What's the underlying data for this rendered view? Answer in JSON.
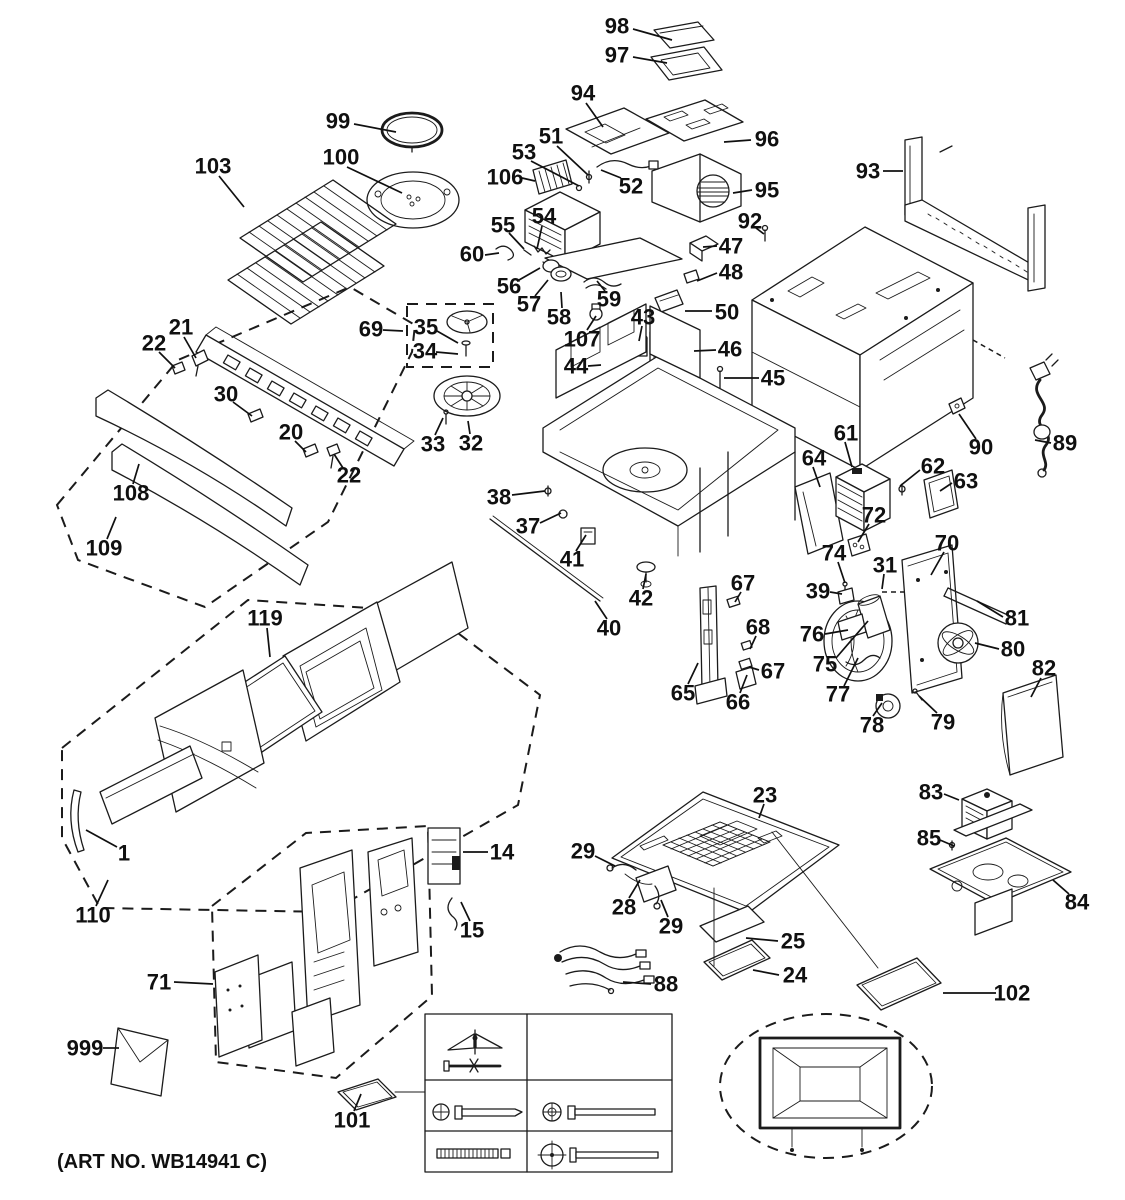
{
  "diagram": {
    "art_no": "(ART NO. WB14941 C)",
    "labels": [
      {
        "id": "98",
        "text": "98",
        "x": 617,
        "y": 26,
        "leader": [
          633,
          29,
          672,
          40
        ]
      },
      {
        "id": "97",
        "text": "97",
        "x": 617,
        "y": 55,
        "leader": [
          633,
          57,
          667,
          63
        ]
      },
      {
        "id": "94",
        "text": "94",
        "x": 583,
        "y": 93,
        "leader": [
          586,
          103,
          603,
          127
        ]
      },
      {
        "id": "99",
        "text": "99",
        "x": 338,
        "y": 121,
        "leader": [
          354,
          124,
          396,
          132
        ]
      },
      {
        "id": "51",
        "text": "51",
        "x": 551,
        "y": 136,
        "leader": [
          557,
          146,
          588,
          175
        ]
      },
      {
        "id": "96",
        "text": "96",
        "x": 767,
        "y": 139,
        "leader": [
          751,
          140,
          724,
          142
        ]
      },
      {
        "id": "53",
        "text": "53",
        "x": 524,
        "y": 152,
        "leader": [
          531,
          161,
          579,
          186
        ]
      },
      {
        "id": "100",
        "text": "100",
        "x": 341,
        "y": 157,
        "leader": [
          347,
          167,
          402,
          193
        ]
      },
      {
        "id": "103",
        "text": "103",
        "x": 213,
        "y": 166,
        "leader": [
          219,
          176,
          244,
          207
        ]
      },
      {
        "id": "93",
        "text": "93",
        "x": 868,
        "y": 171,
        "leader": [
          883,
          171,
          903,
          171
        ]
      },
      {
        "id": "106",
        "text": "106",
        "x": 505,
        "y": 177,
        "leader": [
          522,
          178,
          535,
          181
        ]
      },
      {
        "id": "52",
        "text": "52",
        "x": 631,
        "y": 186,
        "leader": [
          621,
          178,
          601,
          170
        ]
      },
      {
        "id": "95",
        "text": "95",
        "x": 767,
        "y": 190,
        "leader": [
          752,
          190,
          733,
          193
        ]
      },
      {
        "id": "54",
        "text": "54",
        "x": 544,
        "y": 216,
        "leader": [
          542,
          226,
          537,
          249
        ]
      },
      {
        "id": "92",
        "text": "92",
        "x": 750,
        "y": 221,
        "leader": [
          756,
          228,
          764,
          234
        ]
      },
      {
        "id": "55",
        "text": "55",
        "x": 503,
        "y": 225,
        "leader": [
          509,
          233,
          524,
          249
        ]
      },
      {
        "id": "47",
        "text": "47",
        "x": 731,
        "y": 246,
        "leader": [
          717,
          246,
          703,
          247
        ]
      },
      {
        "id": "60",
        "text": "60",
        "x": 472,
        "y": 254,
        "leader": [
          485,
          255,
          499,
          253
        ]
      },
      {
        "id": "48",
        "text": "48",
        "x": 731,
        "y": 272,
        "leader": [
          717,
          273,
          697,
          281
        ]
      },
      {
        "id": "56",
        "text": "56",
        "x": 509,
        "y": 286,
        "leader": [
          519,
          280,
          540,
          268
        ]
      },
      {
        "id": "59",
        "text": "59",
        "x": 609,
        "y": 299,
        "leader": [
          605,
          291,
          597,
          281
        ]
      },
      {
        "id": "57",
        "text": "57",
        "x": 529,
        "y": 304,
        "leader": [
          535,
          296,
          548,
          280
        ]
      },
      {
        "id": "50",
        "text": "50",
        "x": 727,
        "y": 312,
        "leader": [
          712,
          311,
          685,
          311
        ]
      },
      {
        "id": "58",
        "text": "58",
        "x": 559,
        "y": 317,
        "leader": [
          562,
          308,
          561,
          292
        ]
      },
      {
        "id": "43",
        "text": "43",
        "x": 643,
        "y": 317,
        "leader": [
          642,
          326,
          639,
          341
        ]
      },
      {
        "id": "107",
        "text": "107",
        "x": 582,
        "y": 339,
        "leader": [
          587,
          330,
          596,
          316
        ]
      },
      {
        "id": "21",
        "text": "21",
        "x": 181,
        "y": 327,
        "leader": [
          184,
          337,
          196,
          358
        ]
      },
      {
        "id": "69",
        "text": "69",
        "x": 371,
        "y": 329,
        "leader": [
          383,
          330,
          403,
          331
        ]
      },
      {
        "id": "35",
        "text": "35",
        "x": 426,
        "y": 327,
        "leader": [
          437,
          331,
          458,
          343
        ]
      },
      {
        "id": "22-a",
        "text": "22",
        "x": 154,
        "y": 343,
        "leader": [
          159,
          352,
          175,
          368
        ]
      },
      {
        "id": "34",
        "text": "34",
        "x": 425,
        "y": 351,
        "leader": [
          436,
          352,
          458,
          354
        ]
      },
      {
        "id": "46",
        "text": "46",
        "x": 730,
        "y": 349,
        "leader": [
          716,
          350,
          694,
          351
        ]
      },
      {
        "id": "44",
        "text": "44",
        "x": 576,
        "y": 366,
        "leader": [
          588,
          366,
          601,
          365
        ]
      },
      {
        "id": "45",
        "text": "45",
        "x": 773,
        "y": 378,
        "leader": [
          759,
          378,
          724,
          378
        ]
      },
      {
        "id": "30",
        "text": "30",
        "x": 226,
        "y": 394,
        "leader": [
          233,
          402,
          252,
          416
        ]
      },
      {
        "id": "20",
        "text": "20",
        "x": 291,
        "y": 432,
        "leader": [
          295,
          441,
          306,
          452
        ]
      },
      {
        "id": "33",
        "text": "33",
        "x": 433,
        "y": 444,
        "leader": [
          435,
          435,
          443,
          418
        ]
      },
      {
        "id": "32",
        "text": "32",
        "x": 471,
        "y": 443,
        "leader": [
          470,
          434,
          468,
          421
        ]
      },
      {
        "id": "61",
        "text": "61",
        "x": 846,
        "y": 433,
        "leader": [
          845,
          442,
          852,
          467
        ]
      },
      {
        "id": "89",
        "text": "89",
        "x": 1065,
        "y": 443,
        "leader": [
          1051,
          443,
          1035,
          440
        ]
      },
      {
        "id": "90",
        "text": "90",
        "x": 981,
        "y": 447,
        "leader": [
          976,
          439,
          959,
          414
        ]
      },
      {
        "id": "64",
        "text": "64",
        "x": 814,
        "y": 458,
        "leader": [
          813,
          467,
          820,
          487
        ]
      },
      {
        "id": "62",
        "text": "62",
        "x": 933,
        "y": 466,
        "leader": [
          920,
          470,
          900,
          486
        ]
      },
      {
        "id": "22-b",
        "text": "22",
        "x": 349,
        "y": 475,
        "leader": [
          343,
          468,
          334,
          454
        ]
      },
      {
        "id": "63",
        "text": "63",
        "x": 966,
        "y": 481,
        "leader": [
          952,
          483,
          940,
          491
        ]
      },
      {
        "id": "108",
        "text": "108",
        "x": 131,
        "y": 493,
        "leader": [
          133,
          484,
          139,
          464
        ]
      },
      {
        "id": "38",
        "text": "38",
        "x": 499,
        "y": 497,
        "leader": [
          512,
          495,
          545,
          491
        ]
      },
      {
        "id": "72",
        "text": "72",
        "x": 874,
        "y": 515,
        "leader": [
          869,
          524,
          858,
          542
        ]
      },
      {
        "id": "37",
        "text": "37",
        "x": 528,
        "y": 526,
        "leader": [
          540,
          523,
          561,
          513
        ]
      },
      {
        "id": "70",
        "text": "70",
        "x": 947,
        "y": 543,
        "leader": [
          944,
          552,
          931,
          575
        ]
      },
      {
        "id": "109",
        "text": "109",
        "x": 104,
        "y": 548,
        "leader": [
          107,
          539,
          116,
          517
        ]
      },
      {
        "id": "74",
        "text": "74",
        "x": 834,
        "y": 553,
        "leader": [
          838,
          562,
          845,
          583
        ]
      },
      {
        "id": "31",
        "text": "31",
        "x": 885,
        "y": 565,
        "leader": [
          884,
          574,
          882,
          589
        ]
      },
      {
        "id": "41",
        "text": "41",
        "x": 572,
        "y": 559,
        "leader": [
          576,
          551,
          586,
          535
        ]
      },
      {
        "id": "39",
        "text": "39",
        "x": 818,
        "y": 591,
        "leader": [
          830,
          592,
          842,
          594
        ]
      },
      {
        "id": "67-a",
        "text": "67",
        "x": 743,
        "y": 583,
        "leader": [
          741,
          592,
          735,
          602
        ]
      },
      {
        "id": "42",
        "text": "42",
        "x": 641,
        "y": 598,
        "leader": [
          643,
          589,
          646,
          574
        ]
      },
      {
        "id": "81",
        "text": "81",
        "x": 1017,
        "y": 618,
        "leader": [
          1003,
          617,
          977,
          601
        ]
      },
      {
        "id": "119",
        "text": "119",
        "x": 265,
        "y": 618,
        "leader": [
          267,
          628,
          270,
          657
        ]
      },
      {
        "id": "76",
        "text": "76",
        "x": 812,
        "y": 634,
        "leader": [
          825,
          634,
          848,
          630
        ]
      },
      {
        "id": "40",
        "text": "40",
        "x": 609,
        "y": 628,
        "leader": [
          607,
          619,
          595,
          601
        ]
      },
      {
        "id": "68",
        "text": "68",
        "x": 758,
        "y": 627,
        "leader": [
          756,
          636,
          750,
          649
        ]
      },
      {
        "id": "80",
        "text": "80",
        "x": 1013,
        "y": 649,
        "leader": [
          999,
          649,
          975,
          643
        ]
      },
      {
        "id": "75",
        "text": "75",
        "x": 825,
        "y": 664,
        "leader": [
          836,
          658,
          868,
          621
        ]
      },
      {
        "id": "82",
        "text": "82",
        "x": 1044,
        "y": 668,
        "leader": [
          1041,
          678,
          1031,
          697
        ]
      },
      {
        "id": "67-b",
        "text": "67",
        "x": 773,
        "y": 671,
        "leader": [
          759,
          670,
          749,
          667
        ]
      },
      {
        "id": "65",
        "text": "65",
        "x": 683,
        "y": 693,
        "leader": [
          688,
          684,
          698,
          663
        ]
      },
      {
        "id": "77",
        "text": "77",
        "x": 838,
        "y": 694,
        "leader": [
          844,
          686,
          858,
          658
        ]
      },
      {
        "id": "66",
        "text": "66",
        "x": 738,
        "y": 702,
        "leader": [
          740,
          693,
          747,
          675
        ]
      },
      {
        "id": "78",
        "text": "78",
        "x": 872,
        "y": 725,
        "leader": [
          873,
          716,
          882,
          703
        ]
      },
      {
        "id": "79",
        "text": "79",
        "x": 943,
        "y": 722,
        "leader": [
          937,
          713,
          919,
          696
        ]
      },
      {
        "id": "23",
        "text": "23",
        "x": 765,
        "y": 795,
        "leader": [
          764,
          804,
          759,
          818
        ]
      },
      {
        "id": "83",
        "text": "83",
        "x": 931,
        "y": 792,
        "leader": [
          944,
          794,
          959,
          800
        ]
      },
      {
        "id": "85",
        "text": "85",
        "x": 929,
        "y": 838,
        "leader": [
          940,
          840,
          954,
          846
        ]
      },
      {
        "id": "1",
        "text": "1",
        "x": 124,
        "y": 853,
        "leader": [
          117,
          847,
          86,
          830
        ]
      },
      {
        "id": "14",
        "text": "14",
        "x": 502,
        "y": 852,
        "leader": [
          488,
          852,
          463,
          852
        ]
      },
      {
        "id": "29-a",
        "text": "29",
        "x": 583,
        "y": 851,
        "leader": [
          595,
          856,
          615,
          866
        ]
      },
      {
        "id": "84",
        "text": "84",
        "x": 1077,
        "y": 902,
        "leader": [
          1069,
          894,
          1053,
          880
        ]
      },
      {
        "id": "28",
        "text": "28",
        "x": 624,
        "y": 907,
        "leader": [
          629,
          898,
          640,
          880
        ]
      },
      {
        "id": "110",
        "text": "110",
        "x": 93,
        "y": 915,
        "leader": [
          96,
          906,
          108,
          880
        ]
      },
      {
        "id": "15",
        "text": "15",
        "x": 472,
        "y": 930,
        "leader": [
          470,
          921,
          461,
          902
        ]
      },
      {
        "id": "29-b",
        "text": "29",
        "x": 671,
        "y": 926,
        "leader": [
          668,
          917,
          661,
          900
        ]
      },
      {
        "id": "25",
        "text": "25",
        "x": 793,
        "y": 941,
        "leader": [
          778,
          941,
          746,
          938
        ]
      },
      {
        "id": "24",
        "text": "24",
        "x": 795,
        "y": 975,
        "leader": [
          779,
          975,
          753,
          970
        ]
      },
      {
        "id": "71",
        "text": "71",
        "x": 159,
        "y": 982,
        "leader": [
          174,
          982,
          213,
          984
        ]
      },
      {
        "id": "88",
        "text": "88",
        "x": 666,
        "y": 984,
        "leader": [
          651,
          984,
          623,
          982
        ]
      },
      {
        "id": "102",
        "text": "102",
        "x": 1012,
        "y": 993,
        "leader": [
          996,
          993,
          943,
          993
        ]
      },
      {
        "id": "999",
        "text": "999",
        "x": 85,
        "y": 1048,
        "leader": [
          103,
          1048,
          119,
          1048
        ]
      },
      {
        "id": "101",
        "text": "101",
        "x": 352,
        "y": 1120,
        "leader": [
          354,
          1111,
          361,
          1094
        ]
      }
    ]
  }
}
